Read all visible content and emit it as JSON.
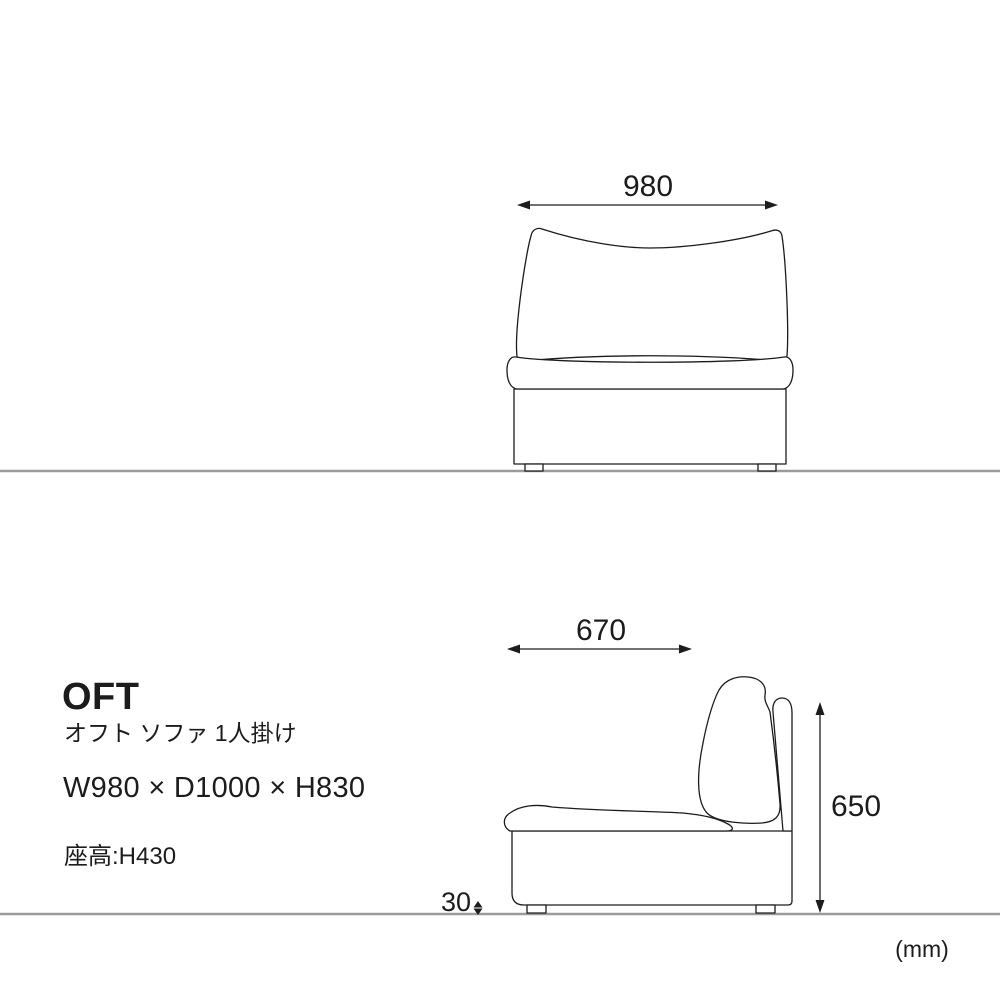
{
  "title_block": {
    "product_code": "OFT",
    "product_name": "オフト ソファ 1人掛け",
    "overall_dimensions": "W980 × D1000 × H830",
    "seat_height": "座高:H430"
  },
  "front_view": {
    "width_label": "980"
  },
  "side_view": {
    "depth_label": "670",
    "height_label": "650",
    "leg_height_label": "30"
  },
  "unit_label": "(mm)",
  "colors": {
    "line": "#1c1c1c",
    "floor_line": "#9b9b9b",
    "background": "#ffffff",
    "text": "#1c1c1c"
  }
}
